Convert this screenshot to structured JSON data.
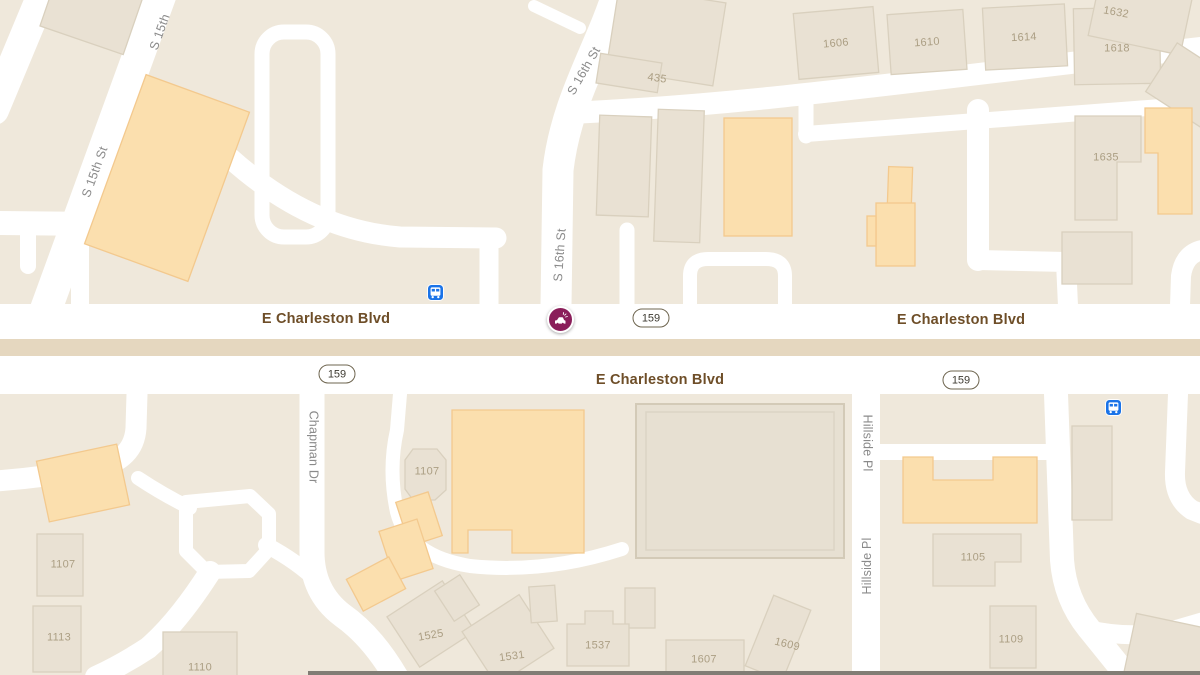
{
  "map": {
    "type": "road-map",
    "colors": {
      "background": "#efe8db",
      "road": "#ffffff",
      "median": "#e5d7bf",
      "building_fill": "#e9e1d3",
      "building_stroke": "#d9d0be",
      "commercial_fill": "#fbdfae",
      "commercial_stroke": "#f3c98e",
      "major_road_label": "#6e4e28",
      "street_label": "#8a8a8a",
      "building_label": "#ab9e83",
      "shield_border": "#6e654f",
      "bus_icon_bg": "#1a73e8",
      "incident_icon_bg": "#8a1e5a"
    },
    "street_labels": [
      {
        "text": "S 15th"
      },
      {
        "text": "S 15th St"
      },
      {
        "text": "S 16th St"
      },
      {
        "text": "S 16th St"
      },
      {
        "text": "Chapman Dr"
      },
      {
        "text": "Hillside Pl"
      },
      {
        "text": "Hillside Pl"
      }
    ],
    "road_labels": [
      {
        "text": "E Charleston Blvd"
      },
      {
        "text": "E Charleston Blvd"
      },
      {
        "text": "E Charleston Blvd"
      }
    ],
    "route_shields": [
      {
        "number": "159"
      },
      {
        "number": "159"
      },
      {
        "number": "159"
      }
    ],
    "building_labels": [
      {
        "text": "435"
      },
      {
        "text": "1606"
      },
      {
        "text": "1610"
      },
      {
        "text": "1614"
      },
      {
        "text": "1618"
      },
      {
        "text": "1632"
      },
      {
        "text": "1635"
      },
      {
        "text": "1107"
      },
      {
        "text": "1107"
      },
      {
        "text": "1113"
      },
      {
        "text": "1110"
      },
      {
        "text": "1525"
      },
      {
        "text": "1531"
      },
      {
        "text": "1537"
      },
      {
        "text": "1607"
      },
      {
        "text": "1609"
      },
      {
        "text": "1105"
      },
      {
        "text": "1109"
      }
    ],
    "icons": {
      "bus_stop": "bus-icon",
      "traffic_incident": "vehicle-incident-icon"
    }
  }
}
